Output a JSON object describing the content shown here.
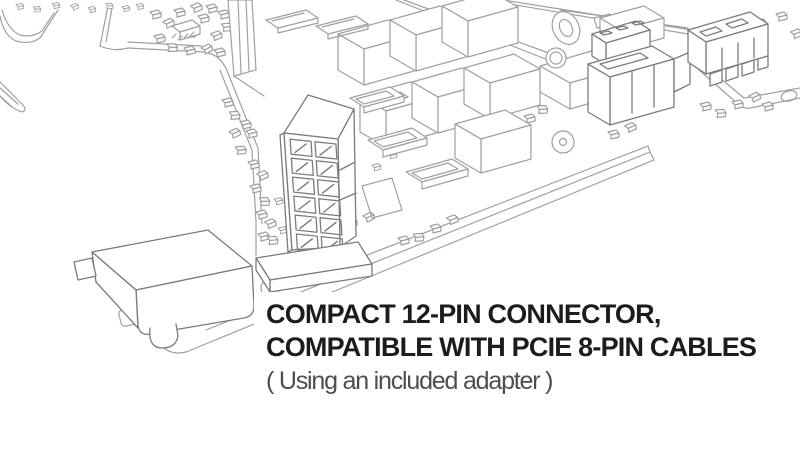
{
  "caption": {
    "heading_line1": "COMPACT 12-PIN CONNECTOR,",
    "heading_line2": "COMPATIBLE WITH PCIE 8-PIN CABLES",
    "subtitle": "( Using an included adapter )"
  },
  "illustration": {
    "connector_pin_columns": 2,
    "connector_pin_rows": 6
  },
  "colors": {
    "background": "#ffffff",
    "heading_text": "#1c1c1c",
    "subtitle_text": "#4e4e4e",
    "line_art": "#a0a0a0",
    "line_art_dark": "#7b7b7b"
  }
}
